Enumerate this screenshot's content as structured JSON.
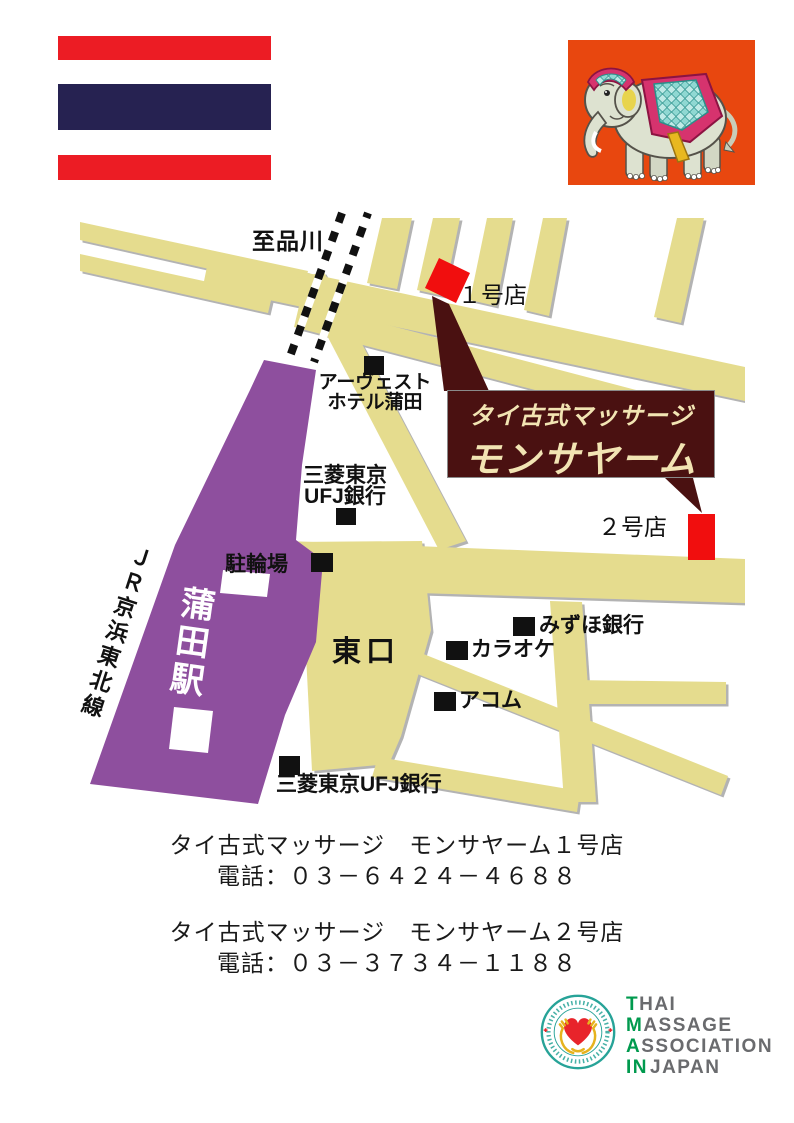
{
  "flag": {
    "red": "#EC1C24",
    "navy": "#262251"
  },
  "map": {
    "to_shinagawa": "至品川",
    "marker1_label": "１号店",
    "marker2_label": "２号店",
    "banner_line1": "タイ古式マッサージ",
    "banner_line2": "モンサヤーム",
    "avest_line1": "アーヴェスト",
    "avest_line2": "ホテル蒲田",
    "ufj_line1": "三菱東京",
    "ufj_line2": "UFJ銀行",
    "bicycle_parking": "駐輪場",
    "kamata_station": "蒲田駅",
    "jr_line": "ＪＲ京浜東北線",
    "east_exit": "東口",
    "mizuho": "みずほ銀行",
    "karaoke": "カラオケ",
    "acom": "アコム",
    "ufj_south": "三菱東京UFJ銀行",
    "colors": {
      "road": "#E5DC8E",
      "station": "#8E4F9E",
      "marker": "#F10E0E",
      "banner": "#4A1111"
    }
  },
  "shops": [
    {
      "name": "タイ古式マッサージ　モンサヤーム１号店",
      "tel": "電話：０３－６４２４－４６８８"
    },
    {
      "name": "タイ古式マッサージ　モンサヤーム２号店",
      "tel": "電話：０３－３７３４－１１８８"
    }
  ],
  "association_logo": {
    "lines": [
      {
        "green": "T",
        "gray": "HAI"
      },
      {
        "green": "M",
        "gray": "ASSAGE"
      },
      {
        "green": "A",
        "gray": "SSOCIATION"
      },
      {
        "green": "IN",
        "gray": "JAPAN"
      }
    ],
    "colors": {
      "green": "#009A4E",
      "gray": "#6A6B6E",
      "teal": "#27A398",
      "heart": "#E8242B",
      "gold": "#E6B31E"
    }
  }
}
